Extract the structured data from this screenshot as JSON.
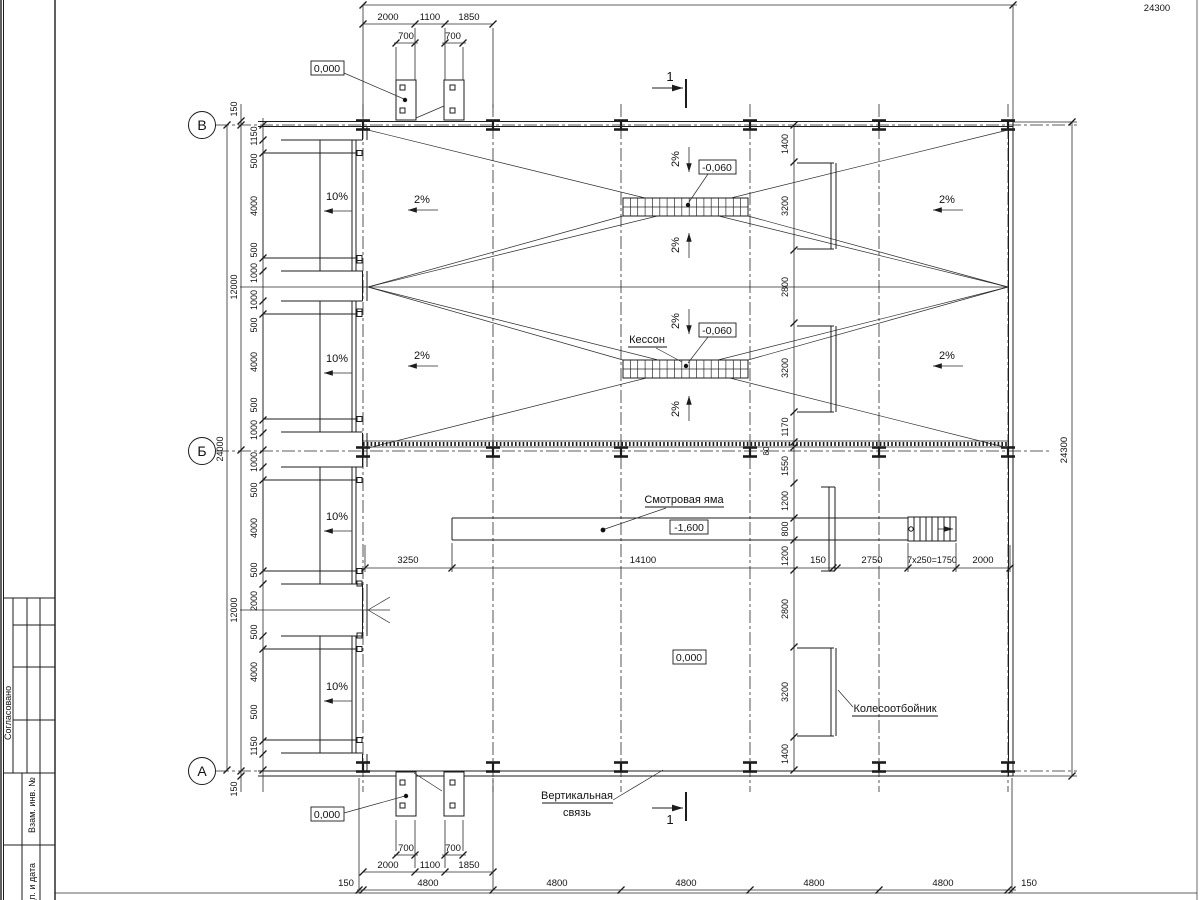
{
  "axes": {
    "bubbles": [
      "В",
      "Б",
      "А"
    ]
  },
  "section_mark": "1",
  "elevations": {
    "zero_top": "0,000",
    "zero_bottom": "0,000",
    "zero_floor": "0,000",
    "grate1": "-0,060",
    "grate2": "-0,060",
    "pit": "-1,600"
  },
  "labels": {
    "kesson": "Кессон",
    "pit": "Смотровая яма",
    "brace_line1": "Вертикальная",
    "brace_line2": "связь",
    "wheel_stop": "Колесоотбойник"
  },
  "slopes": {
    "ramp": "10%",
    "floor": "2%"
  },
  "dims": {
    "top_overall": "24300",
    "right_overall": "24300",
    "left_overall": "24000",
    "left_margin_top": "150",
    "left_margin_bottom": "150",
    "left_half_top": "12000",
    "left_half_bottom": "12000",
    "top_row": [
      "2000",
      "1100",
      "1850"
    ],
    "top_pads": [
      "700",
      "700"
    ],
    "bottom_pads": [
      "700",
      "700"
    ],
    "bottom_row": [
      "2000",
      "1100",
      "1850"
    ],
    "bottom_chain": [
      "150",
      "4800",
      "4800",
      "4800",
      "4800",
      "4800",
      "150"
    ],
    "left_detail": [
      "1150",
      "500",
      "4000",
      "500",
      "1000",
      "1000",
      "500",
      "4000",
      "500",
      "1000",
      "1000",
      "500",
      "4000",
      "500",
      "2000",
      "500",
      "4000",
      "500",
      "1150"
    ],
    "right_detail": [
      "1400",
      "3200",
      "2800",
      "3200",
      "1170",
      "80",
      "1550",
      "1200",
      "800",
      "1200",
      "2800",
      "3200",
      "1400"
    ],
    "pit_row": [
      "3250",
      "14100",
      "150",
      "2750",
      "7x250=1750",
      "2000"
    ]
  },
  "title_block": {
    "agreed": "Согласовано",
    "replace_inv": "Взам. инв. №",
    "sign_date": "Подп. и дата"
  }
}
